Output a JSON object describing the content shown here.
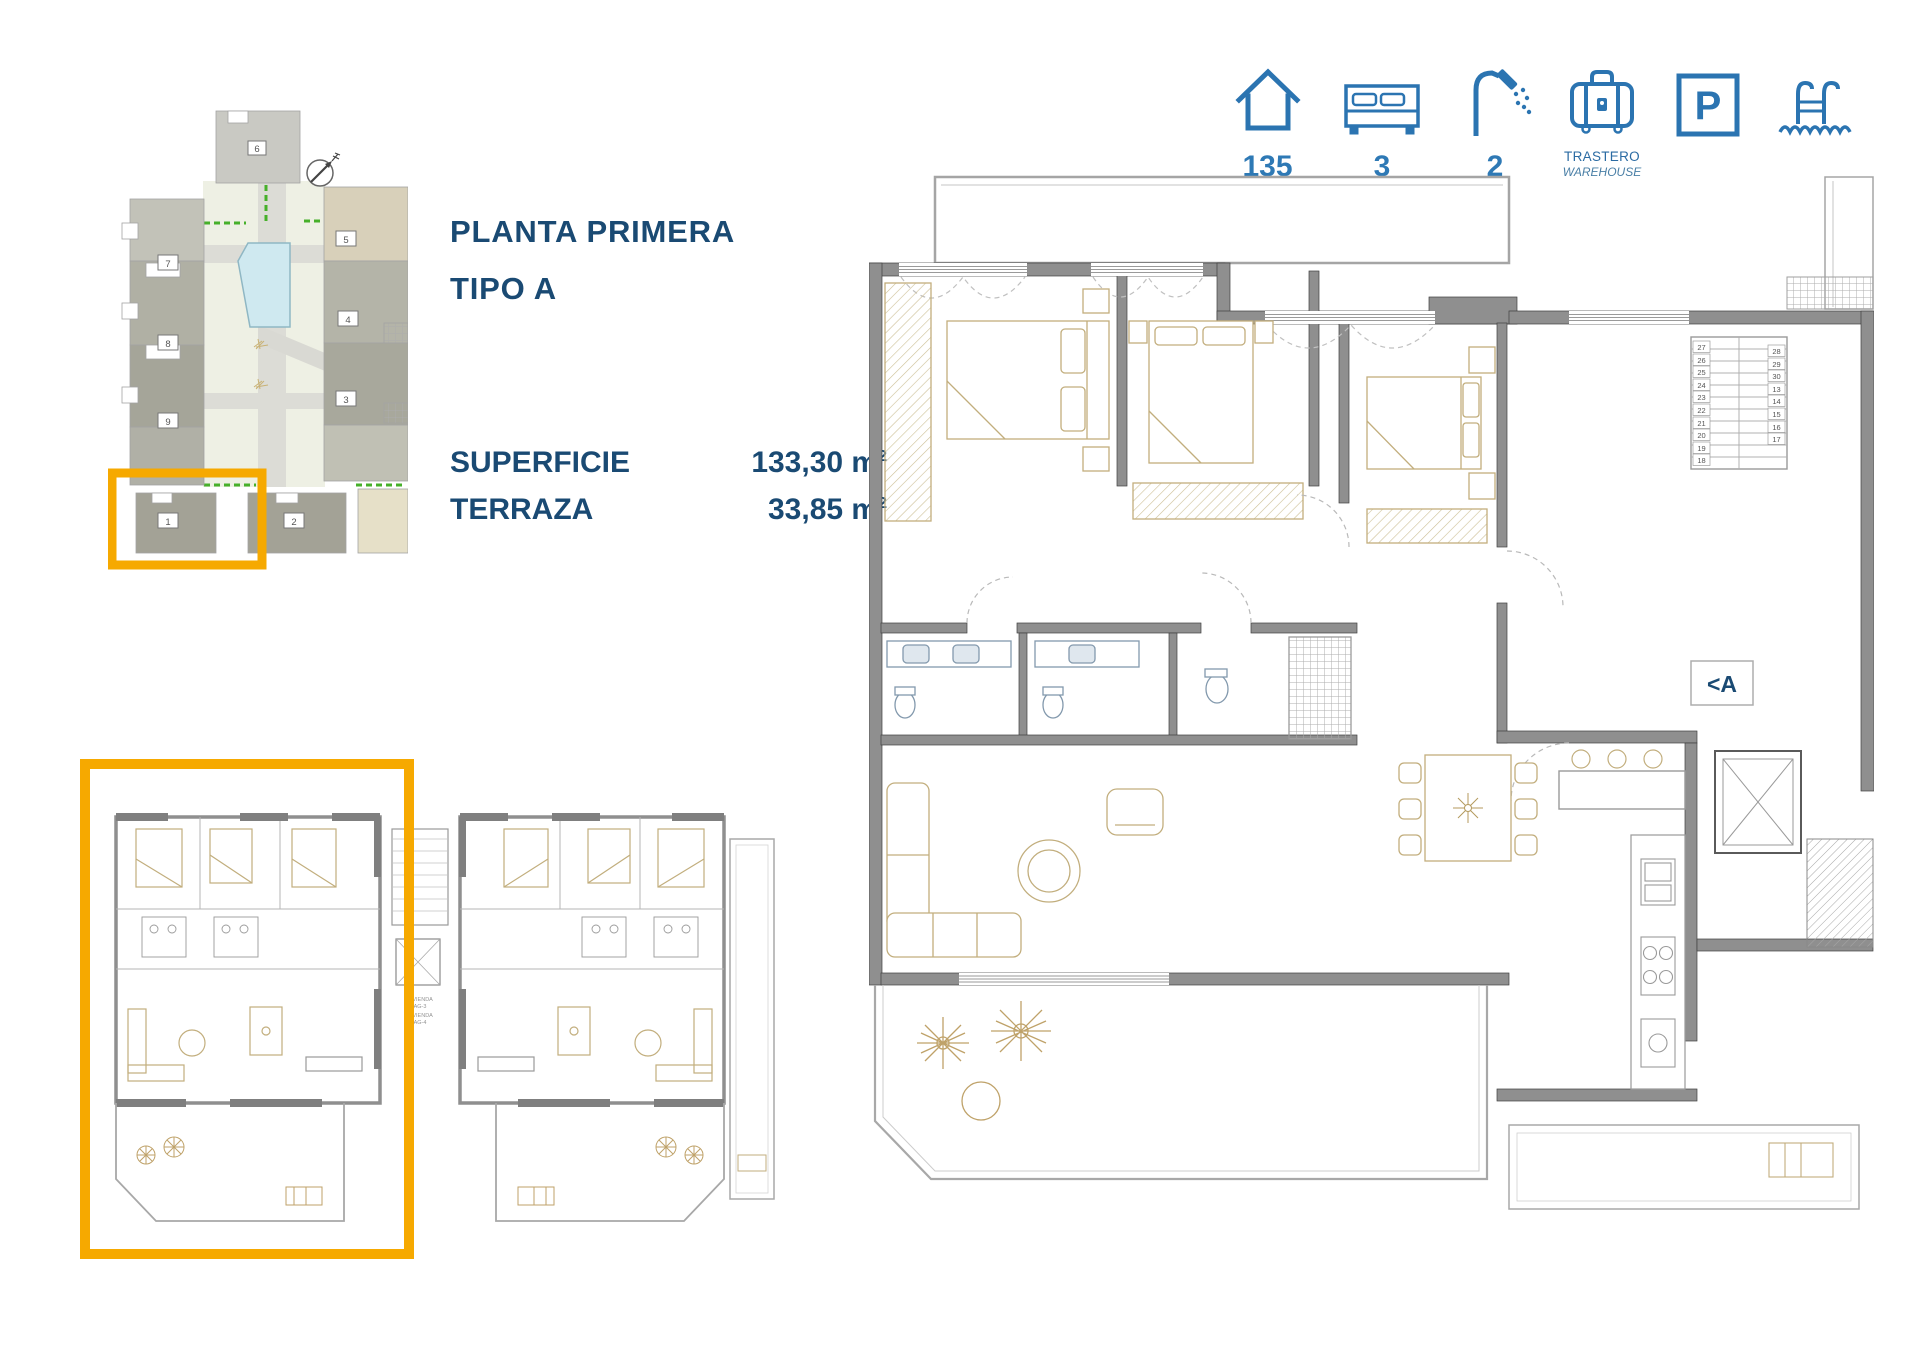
{
  "title": {
    "line1": "PLANTA PRIMERA",
    "line2": "TIPO A"
  },
  "stats": [
    {
      "label": "SUPERFICIE",
      "value": "133,30 m",
      "sup": "2"
    },
    {
      "label": "TERRAZA",
      "value": "33,85 m",
      "sup": "2"
    }
  ],
  "amenities": {
    "surface_value": "135",
    "bedrooms_value": "3",
    "bathrooms_value": "2",
    "storage_label_es": "TRASTERO",
    "storage_label_en": "WAREHOUSE",
    "parking_glyph": "P"
  },
  "site_plan": {
    "numbers": {
      "b1": "1",
      "b2": "2",
      "b3": "3",
      "b4": "4",
      "b5": "5",
      "b6": "6",
      "b7": "7",
      "b8": "8",
      "b9": "9"
    }
  },
  "duplex_plan": {
    "unit_a_line1": "VIVIENDA",
    "unit_a_line2": "AG-3",
    "unit_b_line1": "VIVIENDA",
    "unit_b_line2": "AG-4"
  },
  "main_plan": {
    "section_label": "<A",
    "stair_left": [
      "27",
      "26",
      "25",
      "24",
      "23",
      "22",
      "21",
      "20",
      "19",
      "18"
    ],
    "stair_right": [
      "28",
      "29",
      "30",
      "13",
      "14",
      "15",
      "16",
      "17"
    ]
  },
  "colors": {
    "navy": "#1a4a73",
    "icon_blue": "#2b74b1",
    "accent_orange": "#f6a900",
    "wall_grey": "#8f8f8f",
    "furniture_tan": "#c2ae7d",
    "pool_blue": "#cfe9f0",
    "hedge_green": "#46b02a"
  }
}
